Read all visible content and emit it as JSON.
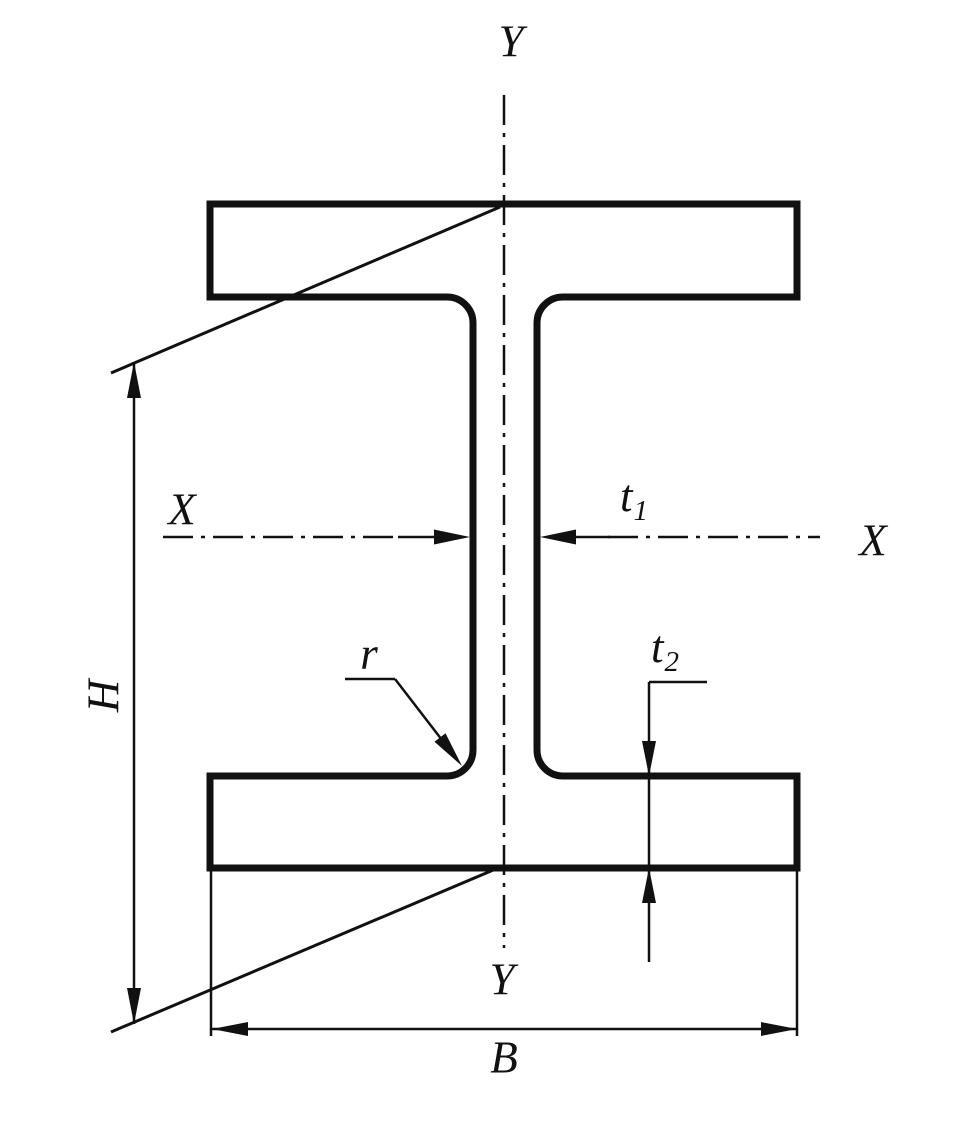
{
  "figure": {
    "type": "engineering-drawing",
    "subject": "I-beam (H-section) cross-section with centerlines and dimension annotations"
  },
  "labels": {
    "axis_y_top": "Y",
    "axis_y_bottom": "Y",
    "axis_x_left": "X",
    "axis_x_right": "X",
    "dim_height": "H",
    "dim_width": "B",
    "dim_web_thickness": {
      "base": "t",
      "sub": "1"
    },
    "dim_flange_thickness": {
      "base": "t",
      "sub": "2"
    },
    "dim_fillet_radius": "r"
  },
  "colors": {
    "line": "#111111",
    "background": "#ffffff"
  }
}
